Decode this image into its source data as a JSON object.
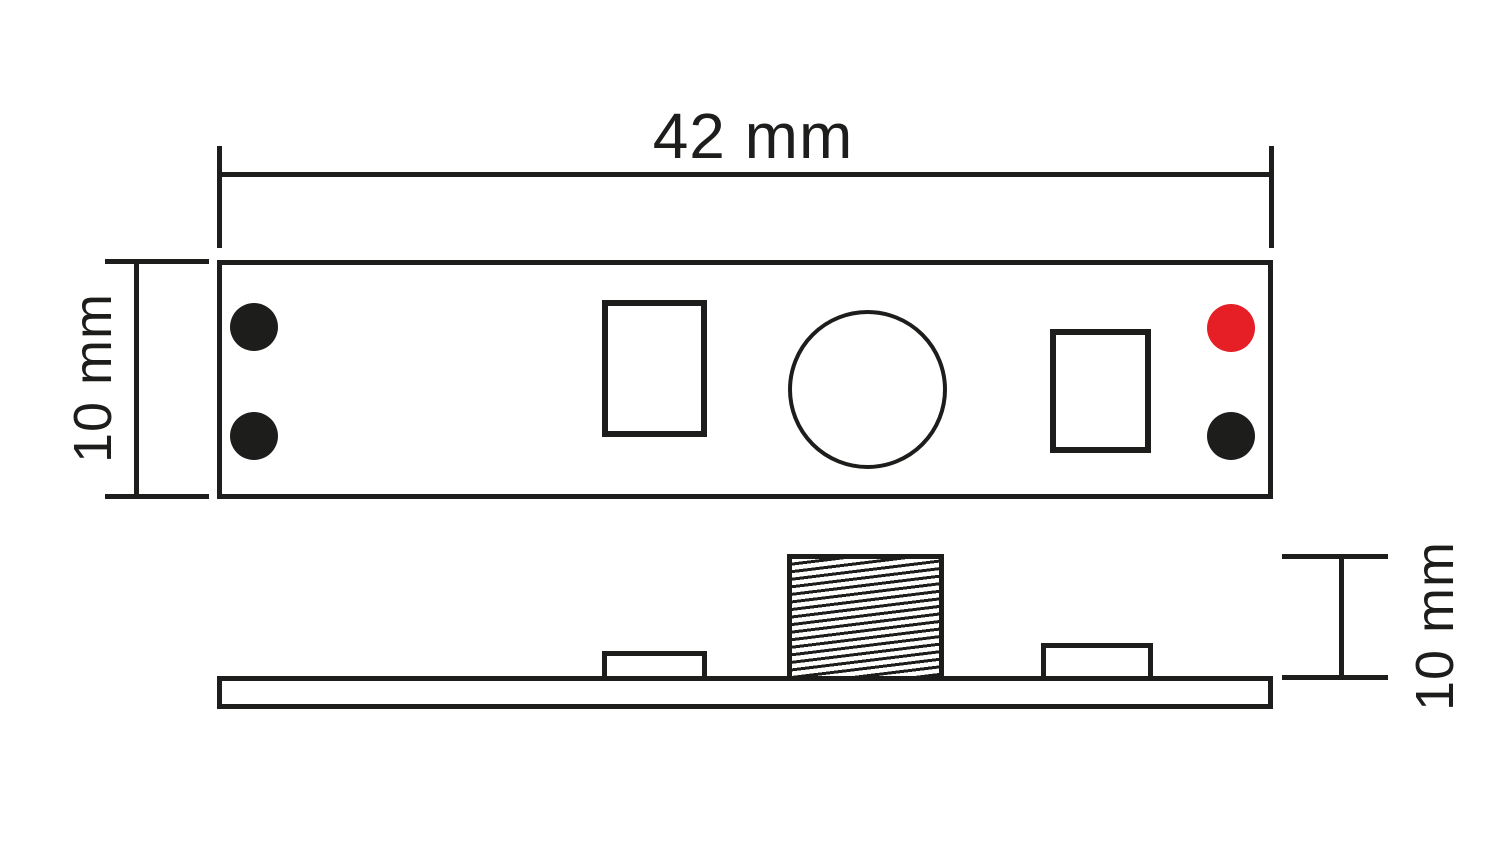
{
  "drawing": {
    "kind": "technical-dimension-drawing",
    "views": {
      "top_view": "module top view with two left solder pads, two rectangular components, round touch button, red and black right solder pads",
      "side_view": "module side profile with flat board, two low components and hatched knob"
    },
    "labels": {
      "top_width": "42 mm",
      "left_height": "10 mm",
      "side_height": "10 mm"
    }
  },
  "colors": {
    "line": "#1d1d1b",
    "background": "#ffffff",
    "red_dot": "#e61e25",
    "pad_dot": "#1d1d1b"
  }
}
